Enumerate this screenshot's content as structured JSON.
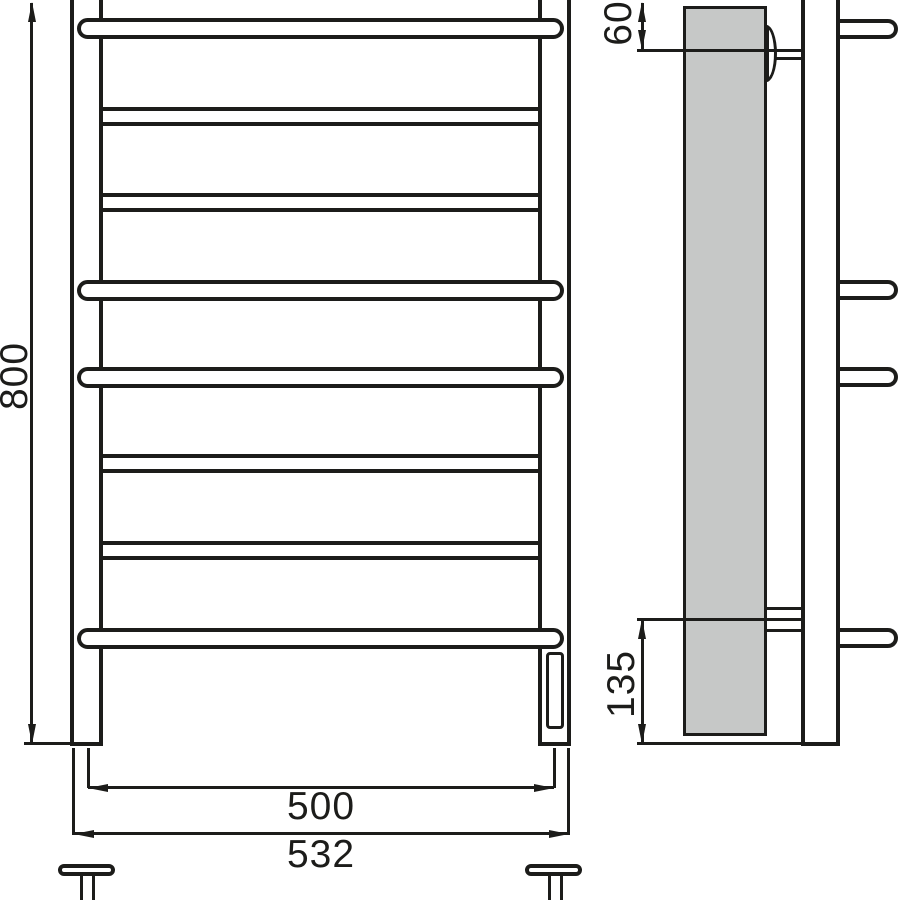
{
  "diagram": {
    "type": "technical-drawing",
    "subject": "heated towel rail ladder, front and side elevation views",
    "dimensions": {
      "overall_height_mm": "800",
      "top_bracket_offset_mm": "60",
      "bottom_bracket_offset_mm": "135",
      "rail_axis_width_mm": "500",
      "overall_width_mm": "532"
    },
    "structure": {
      "total_rungs": 8,
      "bowed_rungs": 4,
      "straight_rungs": 4,
      "wall_brackets": 2,
      "feet": 2
    },
    "colors": {
      "line": "#1c1c1a",
      "panel_fill": "#c6c8c7",
      "background": "#ffffff"
    }
  }
}
